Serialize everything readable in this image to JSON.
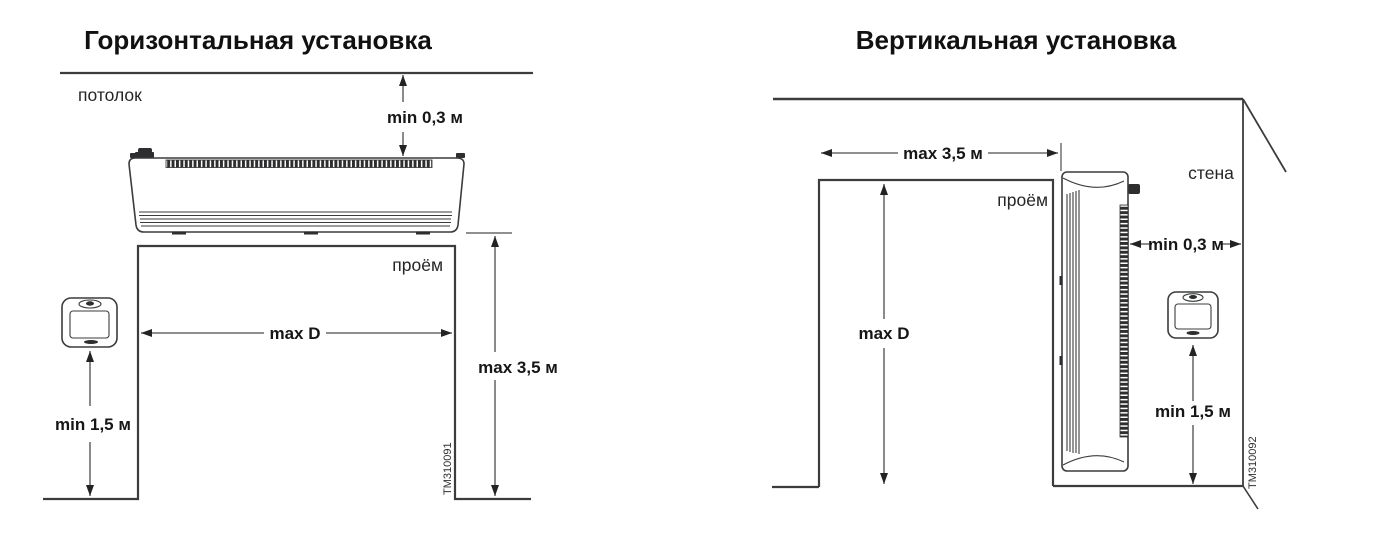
{
  "colors": {
    "background": "#ffffff",
    "structure_line": "#3a3c3e",
    "dimension_line": "#4a4c4e",
    "arrowhead": "#232323",
    "text": "#1a1a1a",
    "unit_dark": "#2e2e30"
  },
  "left": {
    "title": "Горизонтальная установка",
    "labels": {
      "ceiling": "потолок",
      "opening": "проём"
    },
    "dims": {
      "ceiling_clearance": "min 0,3 м",
      "opening_width": "max D",
      "installation_height": "max 3,5 м",
      "thermostat_height": "min 1,5 м"
    },
    "code": "TM310091"
  },
  "right": {
    "title": "Вертикальная установка",
    "labels": {
      "wall": "стена",
      "opening": "проём"
    },
    "dims": {
      "opening_width": "max 3,5 м",
      "wall_clearance": "min 0,3 м",
      "opening_height": "max D",
      "thermostat_height": "min 1,5 м"
    },
    "code": "TM310092"
  }
}
